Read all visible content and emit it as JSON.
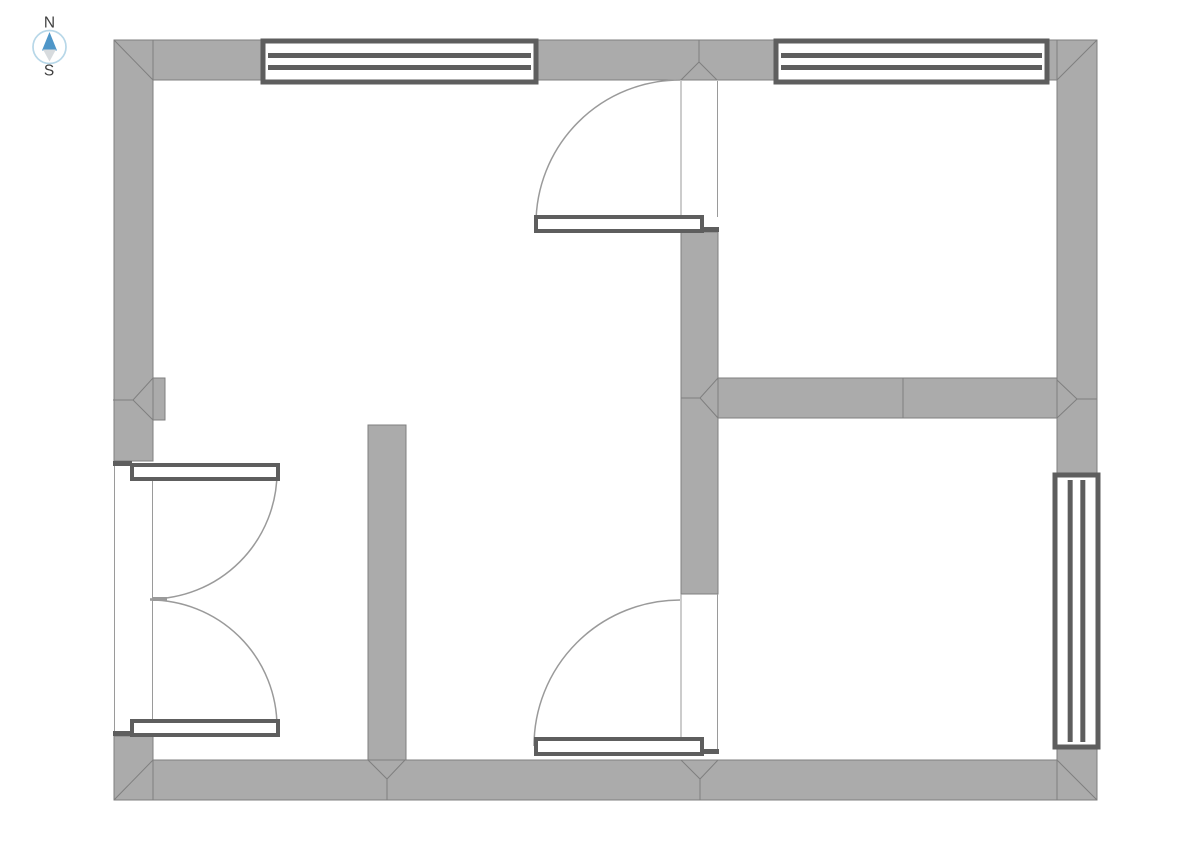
{
  "compass": {
    "north_label": "N",
    "south_label": "S",
    "colors": {
      "ring": "#b7d7e8",
      "north": "#4e96c8",
      "south": "#d7dbde",
      "text": "#3f3f3f"
    },
    "center": {
      "x": 49.5,
      "y": 47
    },
    "radius": 16.5
  },
  "plan": {
    "colors": {
      "wall_fill": "#ababab",
      "wall_stroke": "#7f7f7f",
      "frame": "#5e5e5e",
      "thin": "#9a9a9a",
      "arc": "#9a9a9a",
      "leaf_fill": "#ffffff"
    },
    "frame_thickness": 5,
    "leaf_stroke": 4,
    "walls": [
      {
        "name": "top-wall",
        "x": 114,
        "y": 40,
        "w": 983,
        "h": 40
      },
      {
        "name": "bottom-wall",
        "x": 114,
        "y": 760,
        "w": 983,
        "h": 40
      },
      {
        "name": "left-wall-upper",
        "x": 114,
        "y": 40,
        "w": 39,
        "h": 421
      },
      {
        "name": "left-wall-lower",
        "x": 114,
        "y": 736,
        "w": 39,
        "h": 64
      },
      {
        "name": "left-wall-pilaster",
        "x": 153,
        "y": 378,
        "w": 12,
        "h": 42
      },
      {
        "name": "right-wall-upper",
        "x": 1057,
        "y": 40,
        "w": 40,
        "h": 437
      },
      {
        "name": "right-wall-lower",
        "x": 1057,
        "y": 745,
        "w": 40,
        "h": 55
      },
      {
        "name": "interior-wall-left-vertical",
        "x": 368,
        "y": 425,
        "w": 38,
        "h": 335
      },
      {
        "name": "interior-wall-center-vertical",
        "x": 681,
        "y": 232,
        "w": 37,
        "h": 362
      },
      {
        "name": "interior-wall-right-horizontal",
        "x": 718,
        "y": 378,
        "w": 339,
        "h": 40
      }
    ],
    "seams": [
      {
        "name": "wall-miter-corner-top-left",
        "points": [
          [
            153,
            80
          ],
          [
            114,
            40
          ]
        ]
      },
      {
        "name": "wall-miter-corner-top-right",
        "points": [
          [
            1057,
            80
          ],
          [
            1097,
            40
          ]
        ]
      },
      {
        "name": "wall-miter-corner-bottom-left",
        "points": [
          [
            153,
            760
          ],
          [
            114,
            800
          ]
        ]
      },
      {
        "name": "wall-miter-corner-bottom-right",
        "points": [
          [
            1057,
            760
          ],
          [
            1097,
            800
          ]
        ]
      },
      {
        "name": "wall-seam-top-v-left",
        "points": [
          [
            699,
            40
          ],
          [
            699,
            62
          ],
          [
            681,
            80
          ]
        ]
      },
      {
        "name": "wall-seam-top-v-right",
        "points": [
          [
            699,
            62
          ],
          [
            717,
            80
          ]
        ]
      },
      {
        "name": "wall-seam-bottom-v1",
        "points": [
          [
            368,
            760
          ],
          [
            387,
            779
          ],
          [
            405,
            760
          ]
        ]
      },
      {
        "name": "wall-seam-bottom-v1-stem",
        "points": [
          [
            387,
            779
          ],
          [
            387,
            800
          ]
        ]
      },
      {
        "name": "wall-seam-bottom-v2",
        "points": [
          [
            681,
            760
          ],
          [
            700,
            779
          ],
          [
            718,
            760
          ]
        ]
      },
      {
        "name": "wall-seam-bottom-v2-stem",
        "points": [
          [
            700,
            779
          ],
          [
            700,
            800
          ]
        ]
      },
      {
        "name": "wall-seam-hall-horizontal",
        "points": [
          [
            903,
            378
          ],
          [
            903,
            418
          ]
        ]
      },
      {
        "name": "wall-miter-hall-left",
        "points": [
          [
            718,
            378
          ],
          [
            700,
            398
          ],
          [
            718,
            418
          ]
        ]
      },
      {
        "name": "wall-miter-hall-left-stem",
        "points": [
          [
            681,
            398
          ],
          [
            700,
            398
          ]
        ]
      },
      {
        "name": "wall-miter-hall-right",
        "points": [
          [
            1057,
            380
          ],
          [
            1077,
            399
          ],
          [
            1057,
            418
          ]
        ]
      },
      {
        "name": "wall-miter-hall-right-stem",
        "points": [
          [
            1077,
            399
          ],
          [
            1097,
            399
          ]
        ]
      },
      {
        "name": "wall-miter-pilaster",
        "points": [
          [
            153,
            378
          ],
          [
            133,
            400
          ],
          [
            153,
            420
          ]
        ]
      },
      {
        "name": "wall-miter-pilaster-stem",
        "points": [
          [
            113,
            400
          ],
          [
            133,
            400
          ]
        ]
      }
    ],
    "windows": [
      {
        "name": "window-north-left",
        "x": 263,
        "y": 41,
        "w": 273,
        "h": 41,
        "orientation": "horizontal"
      },
      {
        "name": "window-north-right",
        "x": 776,
        "y": 41,
        "w": 271,
        "h": 41,
        "orientation": "horizontal"
      },
      {
        "name": "window-east",
        "x": 1055,
        "y": 475,
        "w": 43,
        "h": 272,
        "orientation": "vertical"
      }
    ],
    "door_sills": [
      {
        "name": "door-sill-north-hall",
        "x": 702,
        "y": 227,
        "w": 17,
        "h": 5
      },
      {
        "name": "door-sill-south-hall",
        "x": 702,
        "y": 749,
        "w": 17,
        "h": 5
      },
      {
        "name": "door-sill-west-upper",
        "x": 113,
        "y": 461,
        "w": 19,
        "h": 5
      },
      {
        "name": "door-sill-west-lower",
        "x": 113,
        "y": 731,
        "w": 19,
        "h": 5
      }
    ],
    "door_leaves": [
      {
        "name": "door-leaf-north-hall",
        "x": 536,
        "y": 217,
        "w": 166,
        "h": 14
      },
      {
        "name": "door-leaf-south-hall",
        "x": 536,
        "y": 739,
        "w": 166,
        "h": 15
      },
      {
        "name": "door-leaf-west-upper",
        "x": 132,
        "y": 465,
        "w": 146,
        "h": 14
      },
      {
        "name": "door-leaf-west-lower",
        "x": 132,
        "y": 721,
        "w": 146,
        "h": 14
      }
    ],
    "door_jambs": [
      {
        "name": "door-jamb-north-hall-left",
        "x1": 681,
        "y1": 81,
        "x2": 681,
        "y2": 217
      },
      {
        "name": "door-jamb-north-hall-right",
        "x1": 717.5,
        "y1": 81,
        "x2": 717.5,
        "y2": 217
      },
      {
        "name": "door-jamb-south-hall-left",
        "x1": 681,
        "y1": 594,
        "x2": 681,
        "y2": 739
      },
      {
        "name": "door-jamb-south-hall-right",
        "x1": 717.5,
        "y1": 594,
        "x2": 717.5,
        "y2": 749
      },
      {
        "name": "door-jamb-west-outer",
        "x1": 114.5,
        "y1": 466,
        "x2": 114.5,
        "y2": 731
      },
      {
        "name": "door-jamb-west-inner",
        "x1": 152.5,
        "y1": 466,
        "x2": 152.5,
        "y2": 731
      }
    ],
    "door_arcs": [
      {
        "name": "door-swing-arc-north-hall",
        "path": "M 680 80 A 144 144 0 0 0 536 224"
      },
      {
        "name": "door-swing-arc-south-hall",
        "path": "M 680 600 A 146 146 0 0 0 534 746"
      },
      {
        "name": "door-swing-arc-west-upper",
        "path": "M 277 472 A 127 127 0 0 1 150 599"
      },
      {
        "name": "door-swing-arc-west-lower",
        "path": "M 150 600 A 127 127 0 0 1 277 727"
      }
    ],
    "door_meeting_dash": {
      "name": "double-door-meeting-dash",
      "x": 152,
      "y": 597,
      "w": 15,
      "h": 4
    }
  }
}
